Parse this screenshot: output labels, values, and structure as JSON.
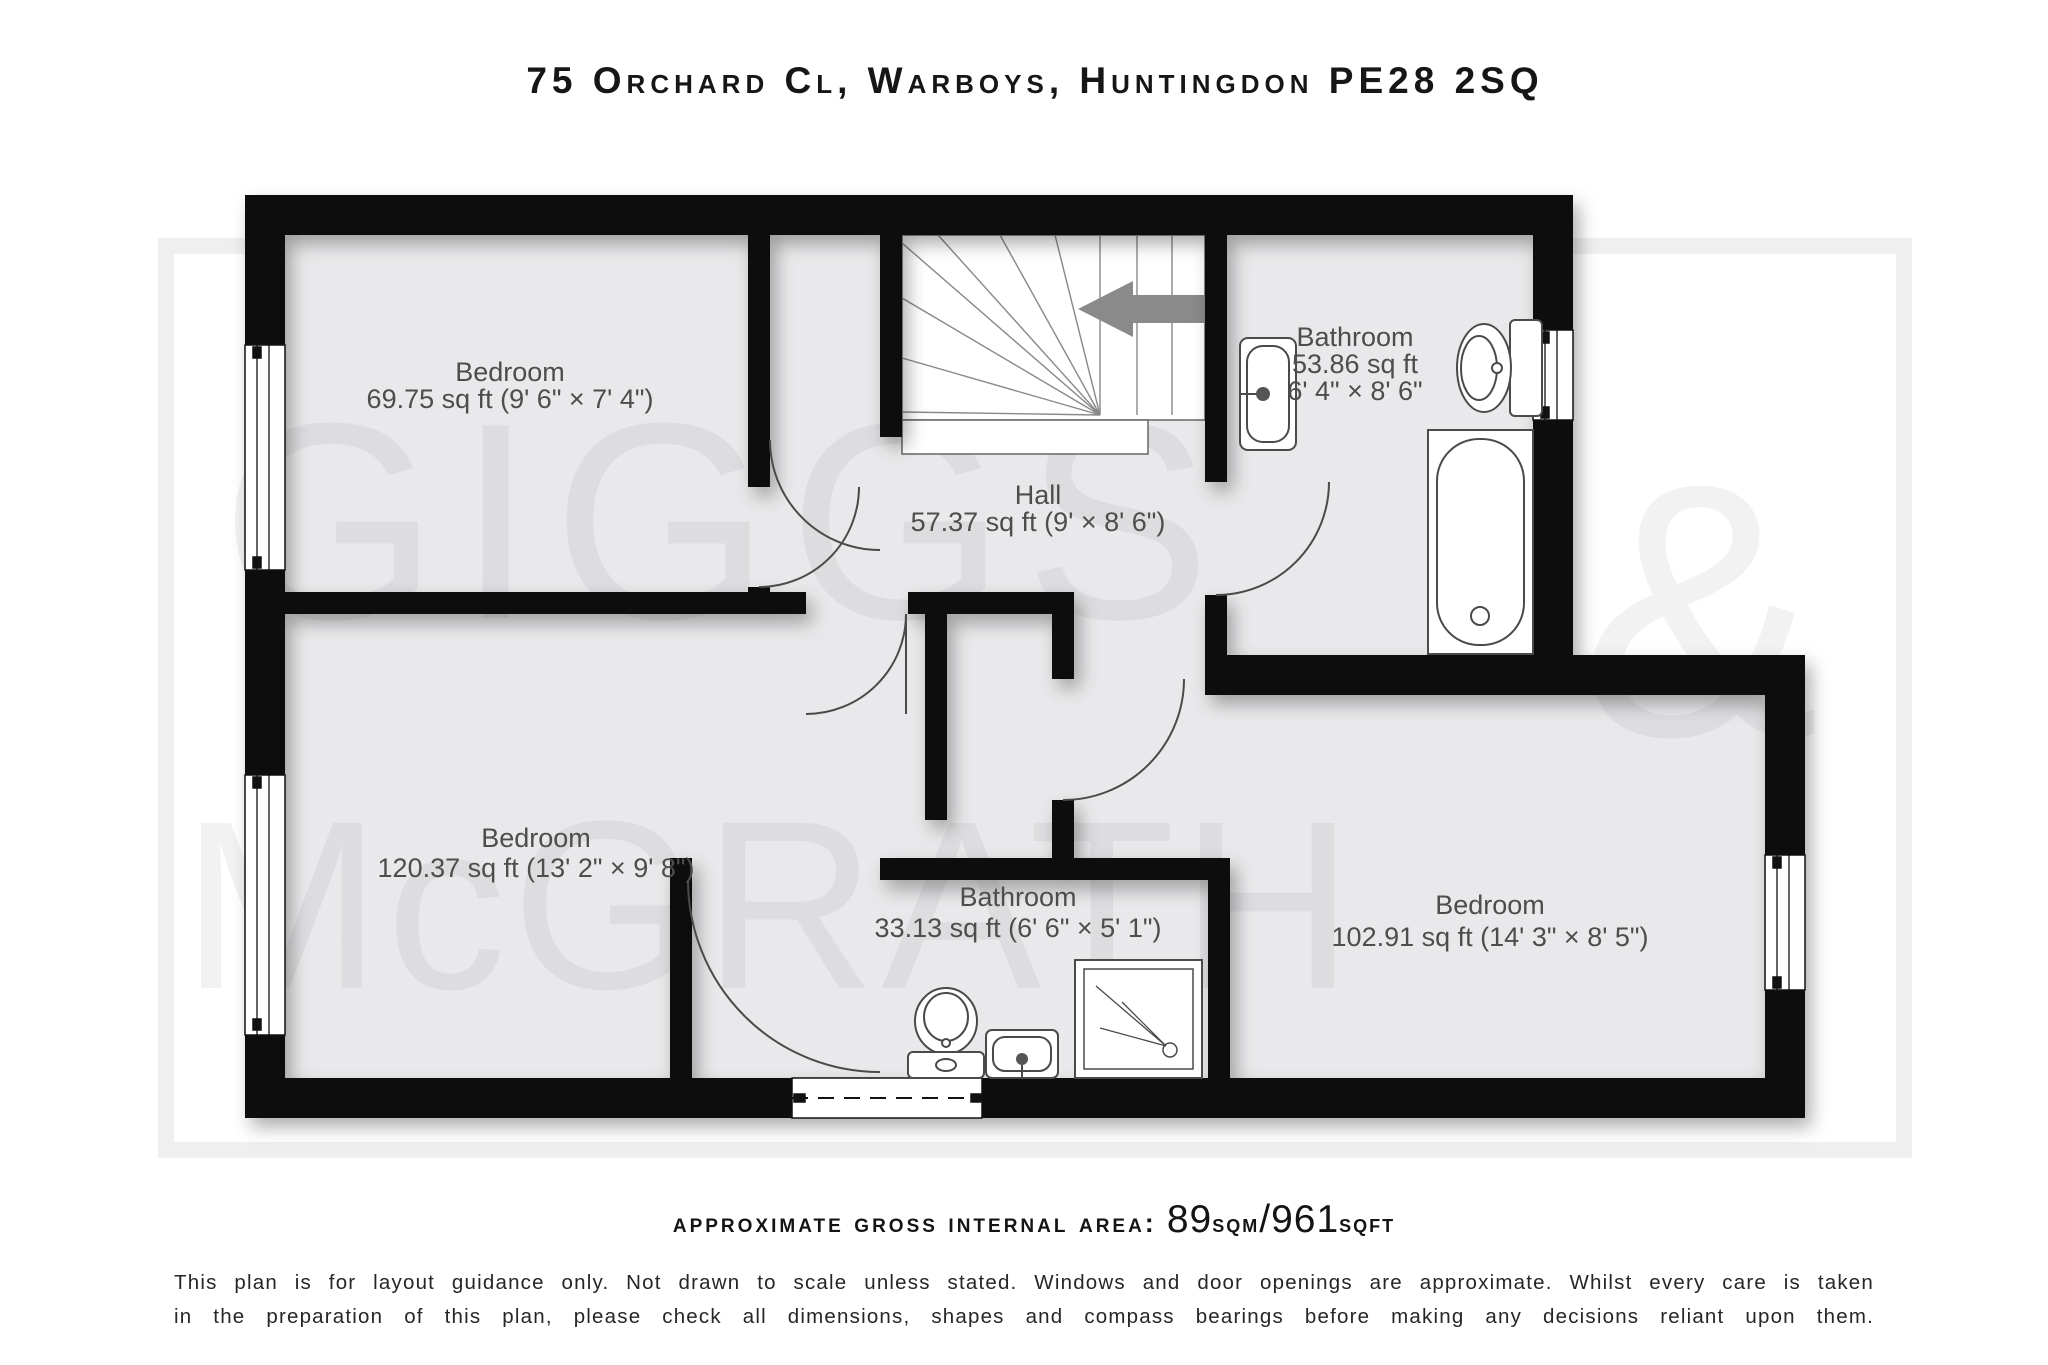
{
  "title": "75 Orchard Cl, Warboys, Huntingdon PE28 2SQ",
  "watermark": {
    "word1": "GIGGS",
    "amp": "&",
    "word2": "McGRATH"
  },
  "rooms": [
    {
      "name": "Bedroom",
      "size": "69.75 sq ft (9' 6\" × 7' 4\")"
    },
    {
      "name": "Hall",
      "size": "57.37 sq ft (9' × 8' 6\")"
    },
    {
      "name": "Bathroom",
      "size": "53.86 sq ft",
      "dims": "6' 4\" × 8' 6\""
    },
    {
      "name": "Bedroom",
      "size": "120.37 sq ft (13' 2\" × 9' 8\")"
    },
    {
      "name": "Bathroom",
      "size": "33.13 sq ft (6' 6\" × 5' 1\")"
    },
    {
      "name": "Bedroom",
      "size": "102.91 sq ft (14' 3\" × 8' 5\")"
    }
  ],
  "area_summary": {
    "label": "approximate gross internal area:",
    "value_sqm": "89",
    "unit_sqm": "sqm",
    "separator": "/",
    "value_sqft": "961",
    "unit_sqft": "sqft"
  },
  "disclaimer": {
    "line1": "This plan is for layout guidance only. Not drawn to scale unless stated. Windows and door openings are approximate. Whilst every care is taken",
    "line2": "in the preparation of this plan, please check all dimensions, shapes and compass bearings before making any decisions reliant upon them."
  }
}
